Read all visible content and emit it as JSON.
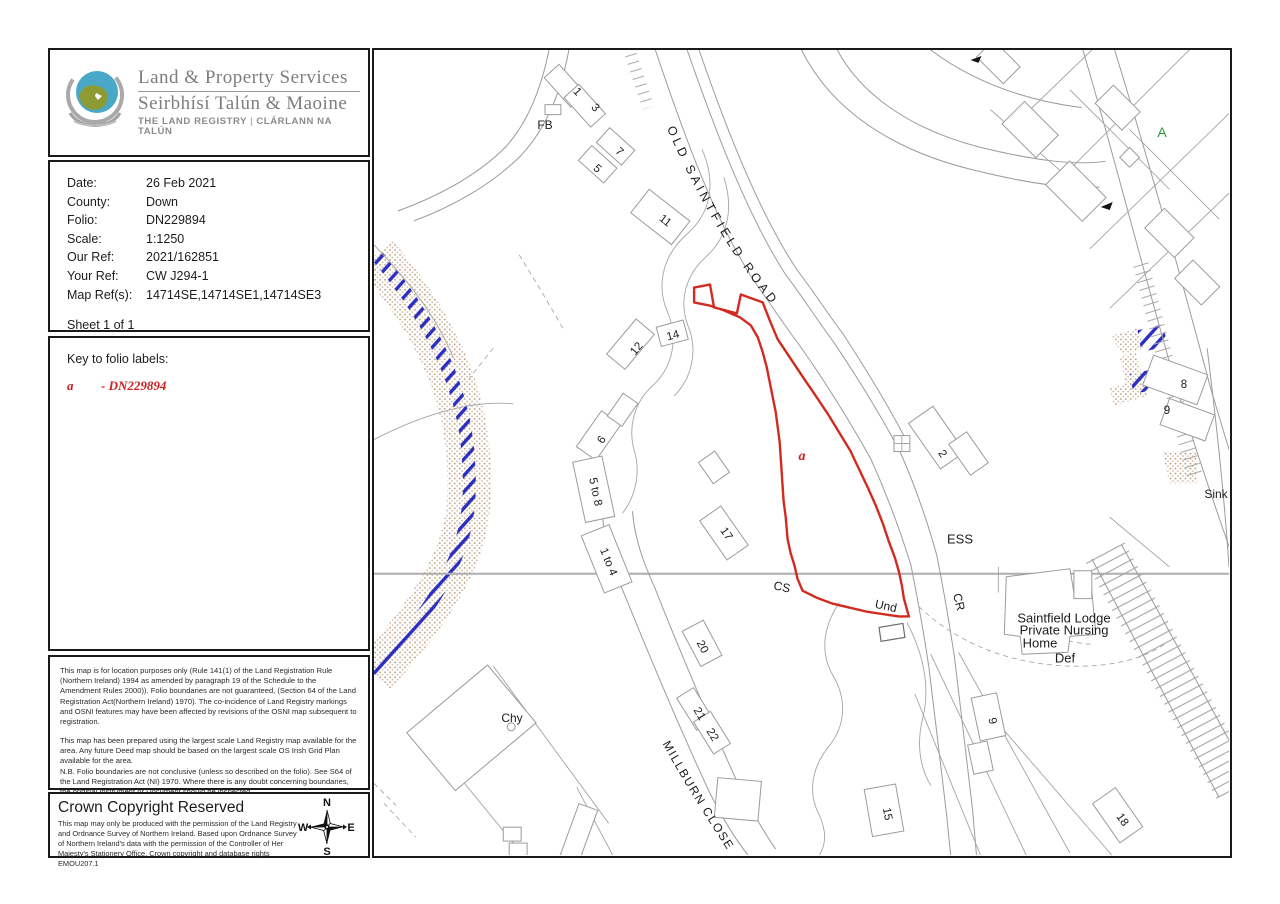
{
  "logo": {
    "title": "Land & Property Services",
    "subtitle": "Seirbhísí Talún & Maoine",
    "tagline_left": "THE LAND REGISTRY",
    "tagline_sep": "|",
    "tagline_right": "CLÁRLANN NA TALÚN",
    "colors": {
      "blue": "#49a8c7",
      "green": "#8e9a33",
      "gray": "#9a9a9a"
    }
  },
  "details": {
    "rows": [
      {
        "label": "Date:",
        "value": "26 Feb 2021"
      },
      {
        "label": "County:",
        "value": "Down"
      },
      {
        "label": "Folio:",
        "value": "DN229894"
      },
      {
        "label": "Scale:",
        "value": "1:1250"
      },
      {
        "label": "Our Ref:",
        "value": "2021/162851"
      },
      {
        "label": "Your Ref:",
        "value": "CW J294-1"
      },
      {
        "label": "Map Ref(s):",
        "value": "14714SE,14714SE1,14714SE3"
      }
    ],
    "sheet": "Sheet 1 of 1"
  },
  "key": {
    "heading": "Key to folio labels:",
    "entries": [
      {
        "label": "a",
        "value": "- DN229894"
      }
    ],
    "color": "#cc1f1f"
  },
  "disclaimer": {
    "blocks": [
      {
        "text": "This map is for location purposes only (Rule 141(1) of the Land Registration Rule (Northern Ireland) 1994 as amended by paragraph 19 of the Schedule to the Amendment Rules 2000)). Folio boundaries are not guaranteed, (Section 64 of the Land Registration Act(Northern Ireland) 1970). The co-incidence of Land Registry markings and OSNI features may have been affected by revisions of the OSNI map subsequent to registration."
      },
      {
        "text": "This map has been prepared using the largest scale Land Registry map available for the area. Any future Deed map should be based on the largest scale OS Irish Grid Plan available for the area."
      },
      {
        "text": "N.B. Folio boundaries are not conclusive (unless so described on the folio). See S64 of the Land Registration Act (NI) 1970. Where there is any doubt concerning boundaries, the original Instrument or Document should be inspected.",
        "tight": true
      },
      {
        "text": "This copy map shows the location of the lands comprised in the folio listed above."
      }
    ]
  },
  "copyright": {
    "heading": "Crown Copyright Reserved",
    "body": "This map may only be produced with the permission of the Land Registry and Ordnance Survey of Northern Ireland.  Based upon Ordnance Survey of Northern Ireland's data with the permission of the Controller of Her Majesty's Stationery Office, Crown copyright and database rights EMOU207.1",
    "compass": {
      "n": "N",
      "e": "E",
      "s": "S",
      "w": "W"
    }
  },
  "map": {
    "colors": {
      "parcel_boundary": "#d22a20",
      "water_hatch": "#2b2fbf",
      "stream_stipple": "#bd9b7d",
      "grid_line": "#aeaeae",
      "map_line": "#9b9b9b",
      "folio_label": "#cc1f1f",
      "area_label": "#2f9641"
    },
    "road_names": {
      "old_saintfield": "OLD SAINTFIELD ROAD",
      "millburn": "MILLBURN CLOSE"
    },
    "labels": [
      {
        "text": "FB",
        "x": 171,
        "y": 75,
        "rot": 0,
        "fs": 12,
        "name": "label-fb"
      },
      {
        "text": "1",
        "x": 203,
        "y": 42,
        "rot": 48
      },
      {
        "text": "3",
        "x": 221,
        "y": 58,
        "rot": 48
      },
      {
        "text": "7",
        "x": 245,
        "y": 102,
        "rot": 42
      },
      {
        "text": "5",
        "x": 223,
        "y": 119,
        "rot": 42
      },
      {
        "text": "11",
        "x": 291,
        "y": 171,
        "rot": 38
      },
      {
        "text": "12",
        "x": 263,
        "y": 299,
        "rot": -50
      },
      {
        "text": "14",
        "x": 299,
        "y": 286,
        "rot": -15
      },
      {
        "text": "6",
        "x": 228,
        "y": 390,
        "rot": -55
      },
      {
        "text": "5 to 8",
        "x": 221,
        "y": 442,
        "rot": 78
      },
      {
        "text": "1 to 4",
        "x": 234,
        "y": 512,
        "rot": 68
      },
      {
        "text": "17",
        "x": 352,
        "y": 484,
        "rot": 55
      },
      {
        "text": "CS",
        "x": 408,
        "y": 537,
        "rot": 12,
        "fs": 12,
        "name": "label-cs"
      },
      {
        "text": "a",
        "x": 428,
        "y": 407,
        "rot": 0,
        "fs": 14,
        "cls": "folio",
        "name": "folio-label-a"
      },
      {
        "text": "Und",
        "x": 512,
        "y": 556,
        "rot": 12,
        "fs": 12,
        "name": "label-und"
      },
      {
        "text": "ESS",
        "x": 586,
        "y": 489,
        "rot": 0,
        "fs": 13,
        "name": "label-ess"
      },
      {
        "text": "CR",
        "x": 585,
        "y": 552,
        "rot": 76,
        "fs": 12,
        "name": "label-cr"
      },
      {
        "text": "2",
        "x": 568,
        "y": 404,
        "rot": 55
      },
      {
        "text": "Saintfield Lodge",
        "x": 690,
        "y": 568,
        "rot": 0,
        "fs": 13,
        "name": "label-saintfield-lodge"
      },
      {
        "text": "Private Nursing",
        "x": 690,
        "y": 580,
        "rot": 0,
        "fs": 13,
        "name": "label-private-nursing"
      },
      {
        "text": "Home",
        "x": 666,
        "y": 593,
        "rot": 0,
        "fs": 13,
        "name": "label-home"
      },
      {
        "text": "Def",
        "x": 691,
        "y": 608,
        "rot": 0,
        "fs": 13,
        "name": "label-def"
      },
      {
        "text": "20",
        "x": 328,
        "y": 597,
        "rot": 62
      },
      {
        "text": "21",
        "x": 325,
        "y": 664,
        "rot": 58
      },
      {
        "text": "22",
        "x": 338,
        "y": 685,
        "rot": 58
      },
      {
        "text": "15",
        "x": 513,
        "y": 764,
        "rot": 80
      },
      {
        "text": "9",
        "x": 618,
        "y": 671,
        "rot": 78
      },
      {
        "text": "18",
        "x": 748,
        "y": 770,
        "rot": 55
      },
      {
        "text": "8",
        "x": 810,
        "y": 335,
        "rot": 0
      },
      {
        "text": "9",
        "x": 793,
        "y": 361,
        "rot": 0
      },
      {
        "text": "Sink",
        "x": 842,
        "y": 444,
        "rot": 0,
        "fs": 12,
        "name": "label-sink"
      },
      {
        "text": "Chy",
        "x": 138,
        "y": 668,
        "rot": 0,
        "fs": 12,
        "name": "label-chy"
      },
      {
        "text": "A",
        "x": 788,
        "y": 82,
        "rot": 0,
        "fs": 14,
        "cls": "area",
        "name": "area-label-a"
      }
    ]
  }
}
